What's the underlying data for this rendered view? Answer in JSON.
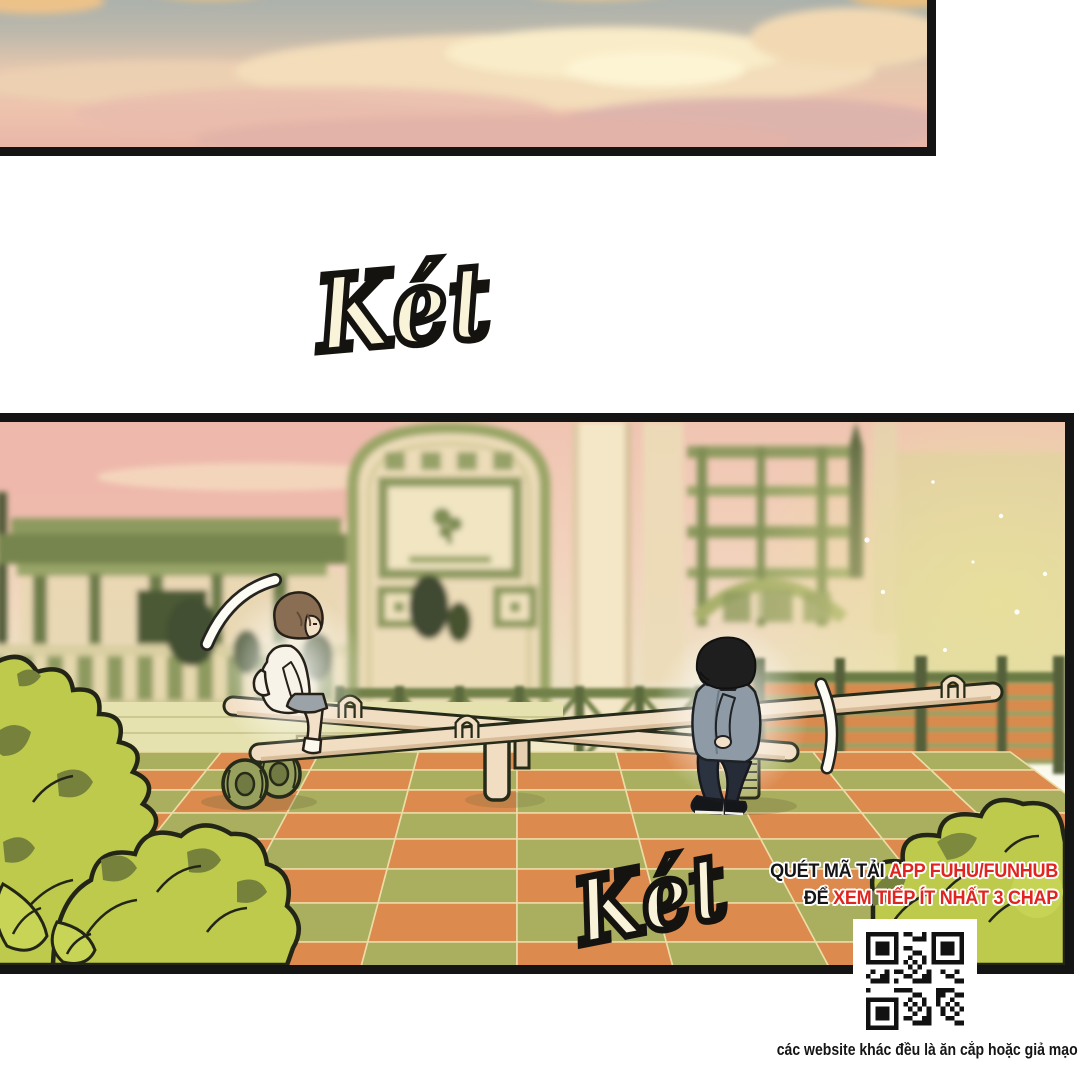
{
  "sfx": {
    "top": "Két",
    "bottom": "Két"
  },
  "promo": {
    "line1_black": "QUÉT MÃ TẢI",
    "line1_red": "APP FUHU/FUNHUB",
    "line2_black": "ĐỂ",
    "line2_red": "XEM TIẾP ÍT NHẤT 3 CHAP"
  },
  "footer": {
    "warning": "các website khác đều là ăn cắp hoặc giả mạo"
  },
  "icons": {
    "qr": "qr-code"
  },
  "colors": {
    "panel-border": "#141414",
    "promo-red": "#e0241f",
    "promo-black": "#151515",
    "sfx-fill": "#f8f3d9",
    "sfx-stroke": "#151310",
    "floor-orange": "#dc8a4d",
    "floor-green": "#a9af5e",
    "floor-line": "#ecdca6",
    "bush-light": "#bdca4b",
    "bush-dark": "#76823c",
    "bush-outline": "#232616",
    "plank": "#f1ddc1",
    "plank-edge": "#d9bd9a",
    "qr-black": "#111111"
  }
}
